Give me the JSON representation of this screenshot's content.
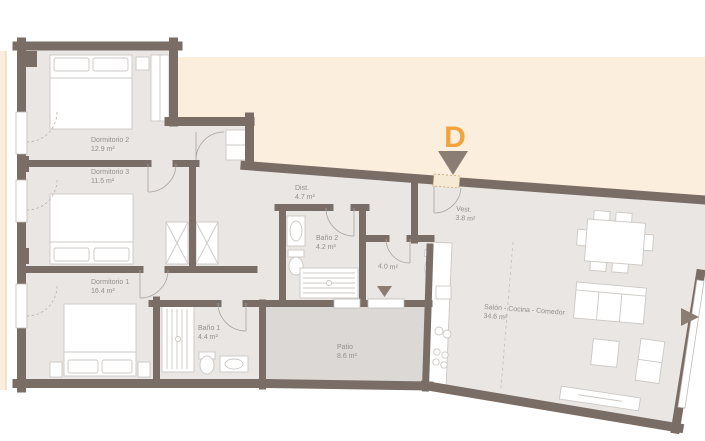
{
  "marker": {
    "label": "D"
  },
  "rooms": [
    {
      "id": "dormitorio-2",
      "name": "Dormitorio 2",
      "area": "12.9 m²"
    },
    {
      "id": "dormitorio-3",
      "name": "Dormitorio 3",
      "area": "11.5 m²"
    },
    {
      "id": "dormitorio-1",
      "name": "Dormitorio 1",
      "area": "16.4 m²"
    },
    {
      "id": "banio-1",
      "name": "Baño 1",
      "area": "4.4 m²"
    },
    {
      "id": "banio-2",
      "name": "Baño 2",
      "area": "4.2 m²"
    },
    {
      "id": "dist",
      "name": "Dist.",
      "area": "4.7 m²"
    },
    {
      "id": "vest",
      "name": "Vest.",
      "area": "3.8 m²"
    },
    {
      "id": "aseo",
      "name": "",
      "area": "4.0 m²"
    },
    {
      "id": "patio",
      "name": "Patio",
      "area": "8.6 m²"
    },
    {
      "id": "salon",
      "name": "Salón - Cocina - Comedor",
      "area": "34.6 m²"
    }
  ],
  "colors": {
    "wall": "#7a6d66",
    "floor": "#e9e6e3",
    "patio_floor": "#dcd8d5",
    "surroundings": "#fceedd",
    "accent": "#f1a33d",
    "marker_arrow": "#8a7d73",
    "label_text": "#93908c"
  }
}
